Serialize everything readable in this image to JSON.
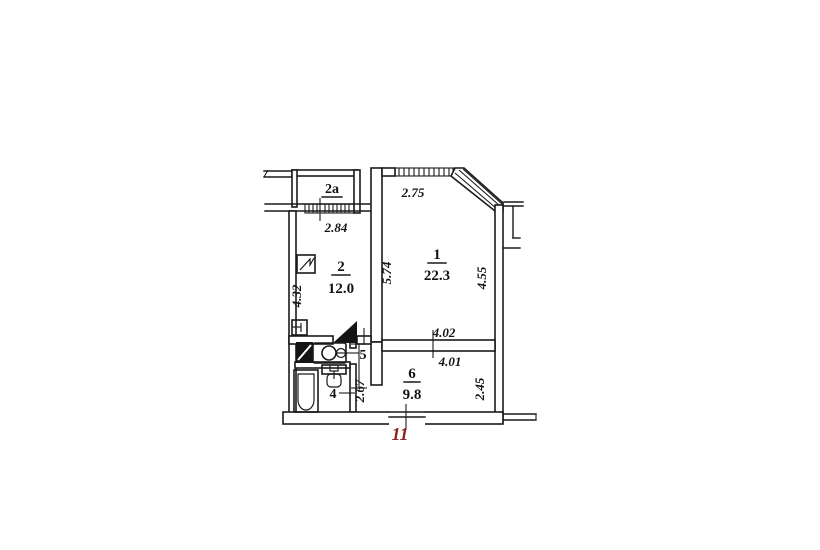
{
  "title": "apartment floor plan",
  "colors": {
    "line": "#1a1a1a",
    "accent": "#8b1e1e",
    "background": "#ffffff"
  },
  "rooms": {
    "balcony": {
      "label": "2a"
    },
    "living": {
      "label": "1",
      "area": "22.3"
    },
    "kitchen": {
      "label": "2",
      "area": "12.0"
    },
    "bathroom": {
      "label": "4"
    },
    "corridor": {
      "label": "5"
    },
    "hall": {
      "label": "6",
      "area": "9.8"
    }
  },
  "dimensions": {
    "kitchen_window": "2.84",
    "kitchen_depth": "4.32",
    "living_window": "2.75",
    "living_left": "5.74",
    "living_right": "4.55",
    "living_bottom": "4.02",
    "hall_width": "4.01",
    "hall_right": "2.45",
    "corridor_depth": "2.67"
  },
  "apartment_number": "11",
  "icons": {
    "vent": "vent-shaft",
    "kitchen_sink": "kitchen-sink",
    "washer": "washing-machine",
    "basin": "wash-basin",
    "toilet": "toilet",
    "bathtub": "bathtub",
    "door": "door-leaf"
  }
}
